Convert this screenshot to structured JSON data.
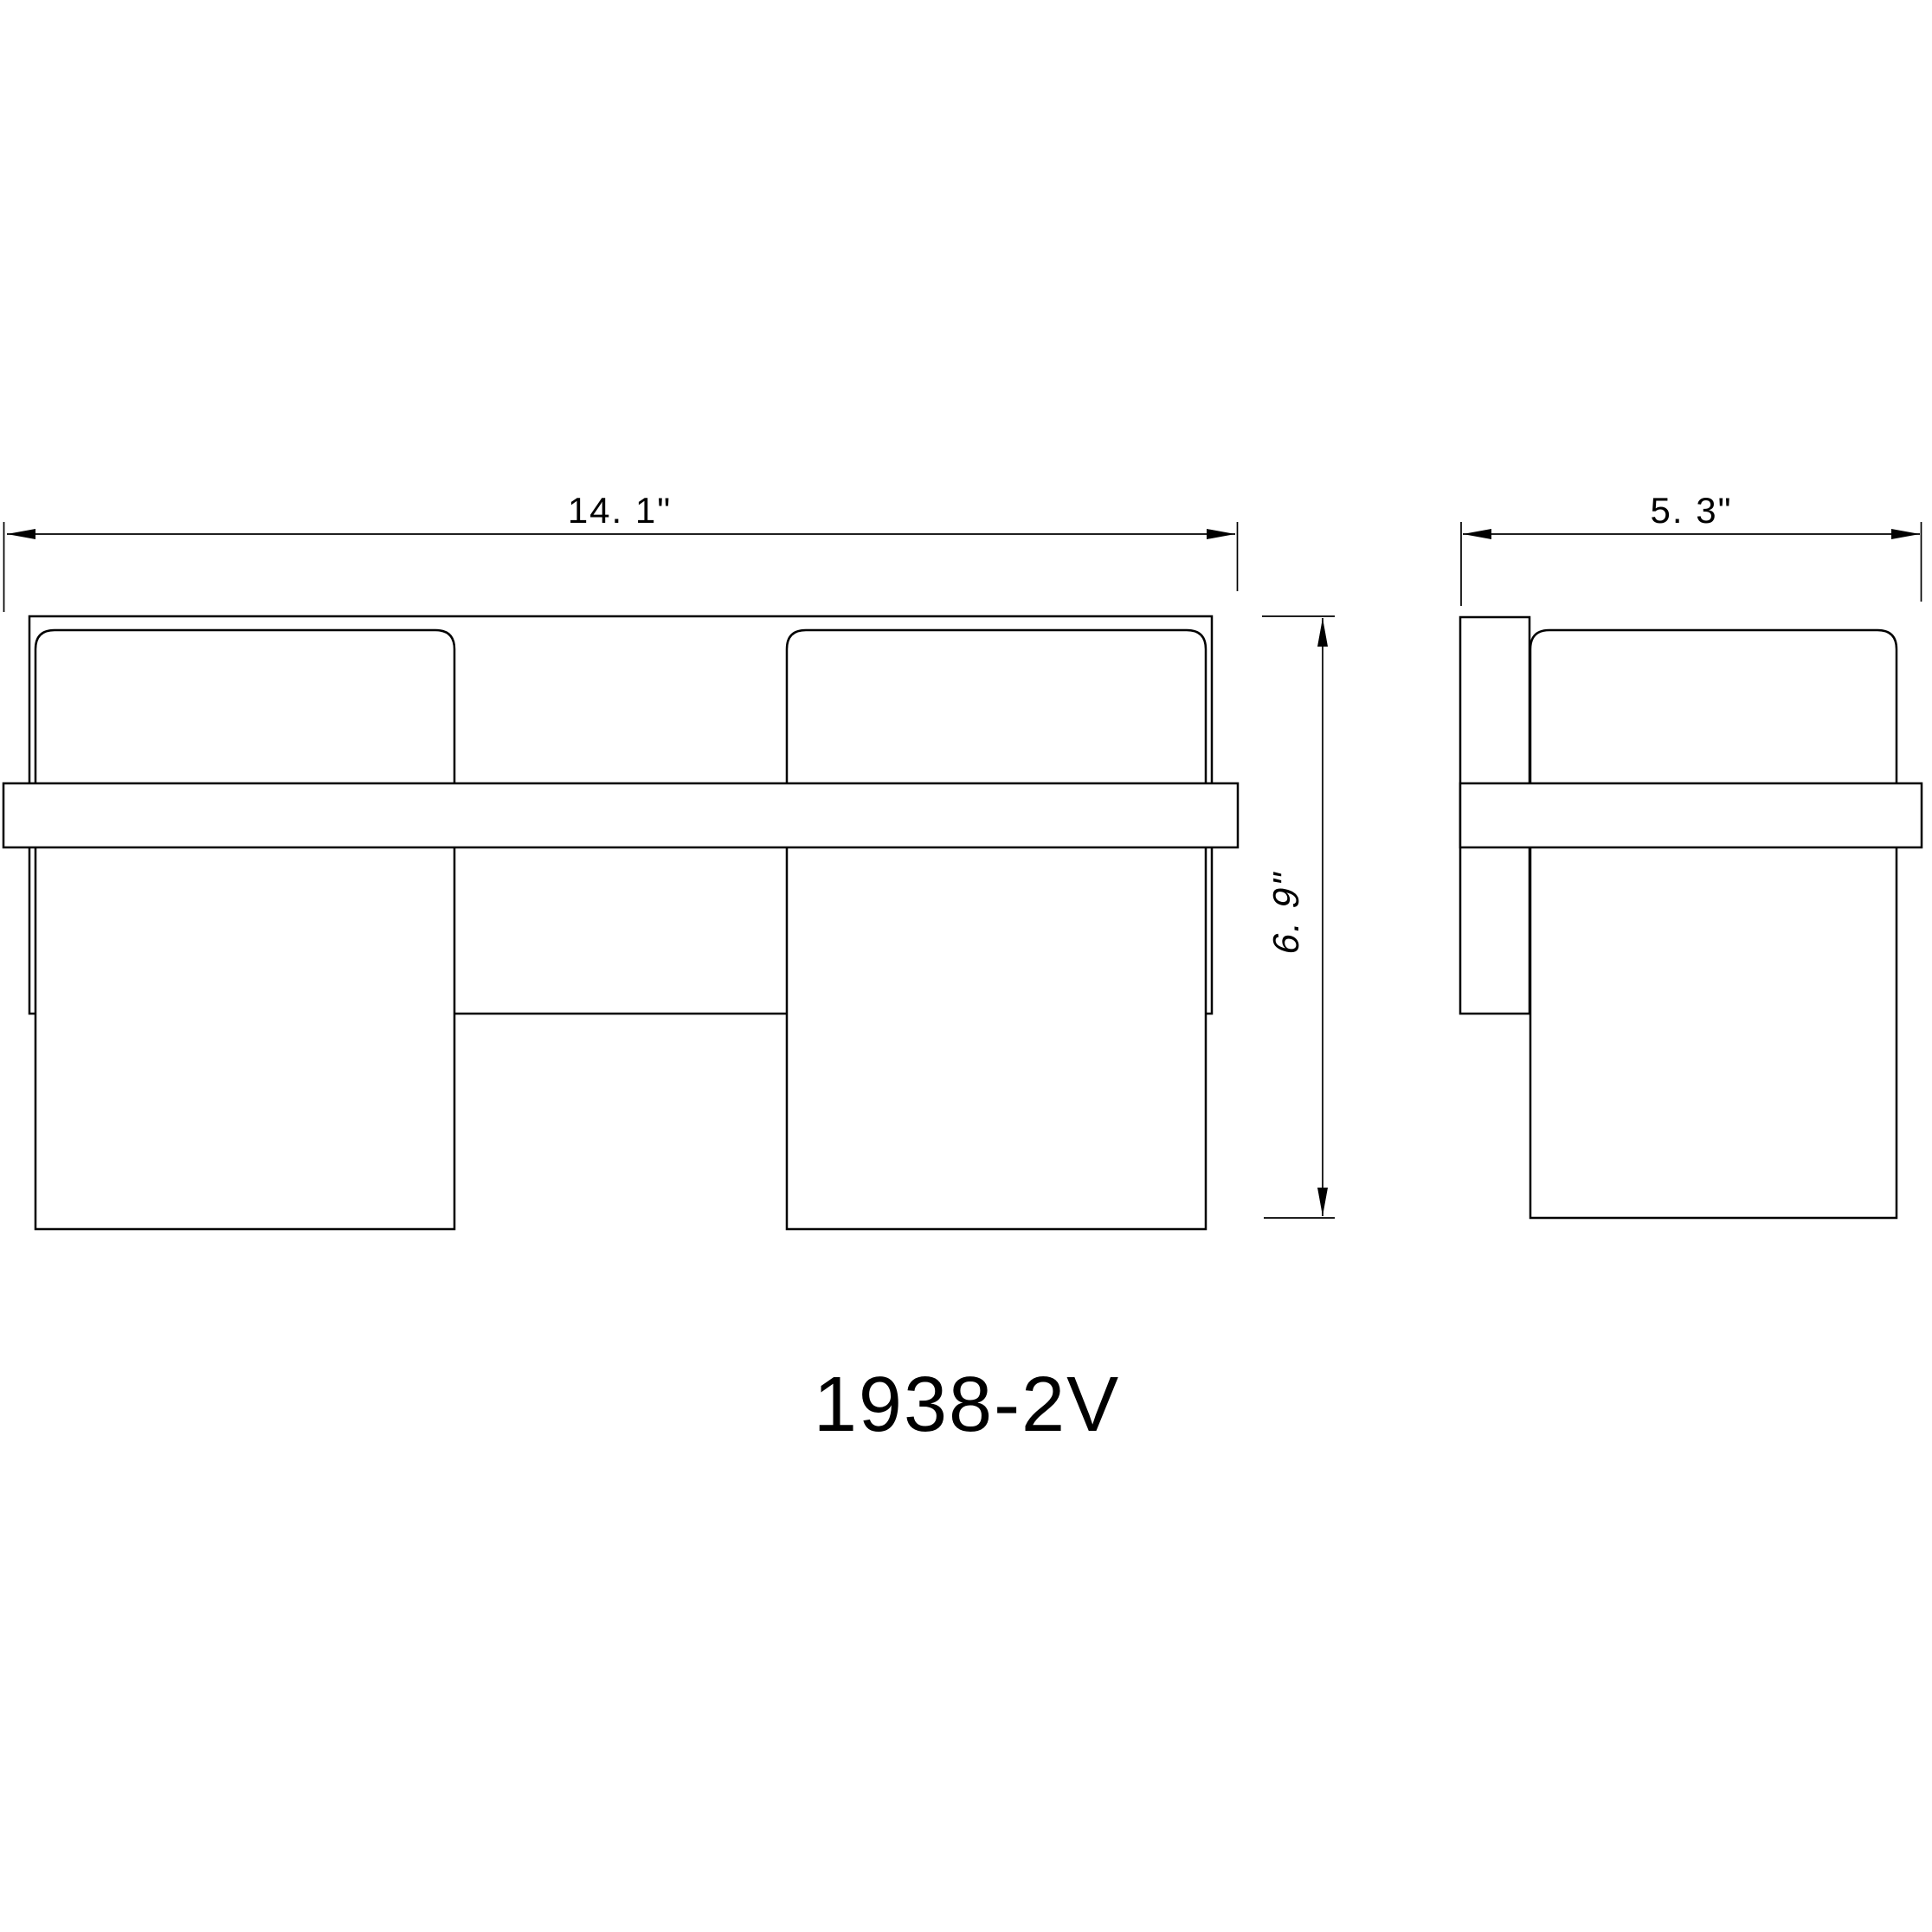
{
  "colors": {
    "line": "#000000",
    "background": "#ffffff"
  },
  "model_number": "1938-2V",
  "front_view": {
    "width_dimension_label": "14. 1\""
  },
  "side_view": {
    "depth_dimension_label": "5. 3\"",
    "height_dimension_label": "6. 9\""
  }
}
